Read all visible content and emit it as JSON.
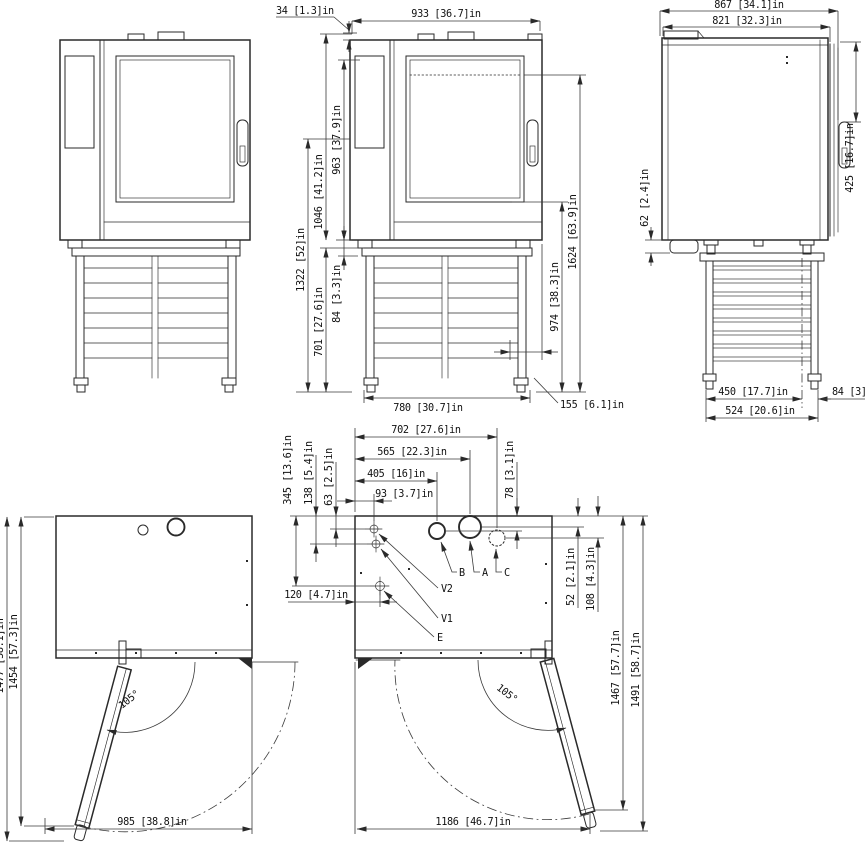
{
  "drawing": {
    "front_view": {
      "dim_cap_height": "34 [1.3]in",
      "dim_width": "933 [36.7]in",
      "dim_door_height": "963 [37.9]in",
      "dim_body_height": "1046 [41.2]in",
      "dim_mid_height": "1322 [52]in",
      "dim_stand_height": "701 [27.6]in",
      "dim_foot_height": "84 [3.3]in",
      "dim_total_height": "1624 [63.9]in",
      "dim_window_floor": "974 [38.3]in",
      "dim_stand_width": "780 [30.7]in",
      "dim_leg_inset": "155 [6.1]in"
    },
    "side_view": {
      "dim_depth_total": "867 [34.1]in",
      "dim_depth_body": "821 [32.3]in",
      "dim_handle_top": "425 [16.7]in",
      "dim_drain_height": "62 [2.4]in",
      "dim_leg_spacing": "450 [17.7]in",
      "dim_leg_offset": "84 [3]in",
      "dim_stand_depth": "524 [20.6]in"
    },
    "top_view_closed": {
      "dim_depth_outer": "1477 [58.1]in",
      "dim_depth_open": "1454 [57.3]in",
      "dim_width_open": "985 [38.8]in",
      "door_angle": "105°"
    },
    "top_view_connections": {
      "dim_c_x": "702 [27.6]in",
      "dim_a_x": "565 [22.3]in",
      "dim_b_x": "405 [16]in",
      "dim_v_x": "93 [3.7]in",
      "dim_b_y": "78 [3.1]in",
      "dim_a_y": "52 [2.1]in",
      "dim_c_y": "108 [4.3]in",
      "dim_e_y": "345 [13.6]in",
      "dim_v1_y": "138 [5.4]in",
      "dim_v2_y": "63 [2.5]in",
      "dim_e_x": "120 [4.7]in",
      "dim_depth_tip": "1467 [57.7]in",
      "dim_depth_handle": "1491 [58.7]in",
      "dim_width_open": "1186 [46.7]in",
      "door_angle": "105°",
      "labels": {
        "v2": "V2",
        "v1": "V1",
        "e": "E",
        "b": "B",
        "a": "A",
        "c": "C"
      }
    }
  }
}
